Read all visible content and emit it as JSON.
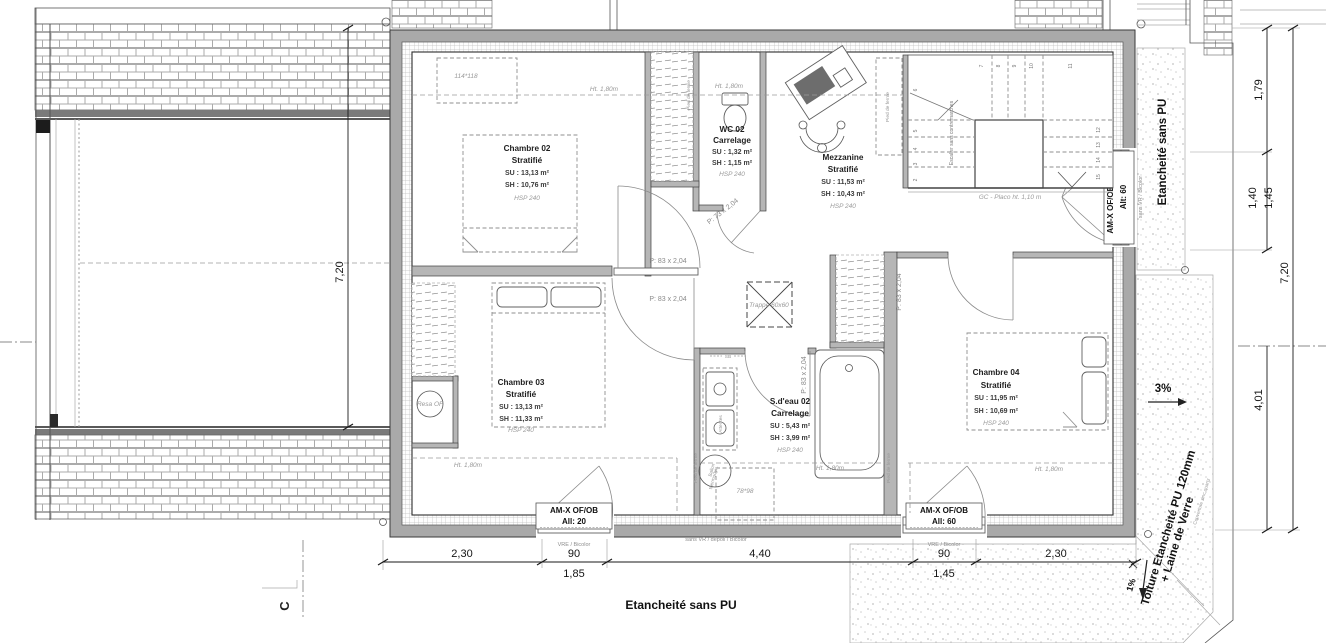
{
  "rooms": {
    "chambre02": {
      "name": "Chambre 02",
      "finish": "Stratifié",
      "su": "SU : 13,13 m²",
      "sh": "SH : 10,76 m²",
      "hsp": "HSP 240"
    },
    "wc02": {
      "name": "WC 02",
      "finish": "Carrelage",
      "su": "SU : 1,32 m²",
      "sh": "SH : 1,15 m²",
      "hsp": "HSP 240"
    },
    "mezzanine": {
      "name": "Mezzanine",
      "finish": "Stratifié",
      "su": "SU : 11,53 m²",
      "sh": "SH : 10,43 m²",
      "hsp": "HSP 240"
    },
    "chambre03": {
      "name": "Chambre 03",
      "finish": "Stratifié",
      "su": "SU : 13,13 m²",
      "sh": "SH : 11,33 m²",
      "hsp": "HSP 240"
    },
    "sdeau02": {
      "name": "S.d'eau 02",
      "finish": "Carrelage",
      "su": "SU : 5,43 m²",
      "sh": "SH : 3,99 m²",
      "hsp": "HSP 240"
    },
    "chambre04": {
      "name": "Chambre 04",
      "finish": "Stratifié",
      "su": "SU : 11,95 m²",
      "sh": "SH : 10,69 m²",
      "hsp": "HSP 240"
    }
  },
  "stairs": {
    "numbers": [
      "2",
      "3",
      "4",
      "5",
      "6",
      "7",
      "8",
      "9",
      "10",
      "11",
      "12",
      "13",
      "14",
      "15"
    ],
    "note": "Escalier sans contremarches",
    "gc": "GC - Placo ht. 1,10 m"
  },
  "doors": {
    "p83": "P: 83 x 2,04",
    "p73": "P: 73 x 2,04"
  },
  "windows": {
    "w20_1": "AM-X OF/OB",
    "w20_2": "All: 20",
    "w60_1": "AM-X OF/OB",
    "w60_2": "All: 60",
    "wfixe_1": "AM-X OF/OB + Fixe",
    "wfixe_2": "Alt: 60",
    "vre": "VRE / Bicolor",
    "sans_vr_bicolor": "sans VR / Bicolor",
    "sans_vr_depoli": "sans VR / dépoli / Bicolor"
  },
  "annotations": {
    "ht180": "Ht. 1,80m",
    "velux_top": "114*118",
    "velux_bottom": "78*98",
    "trappe": "Trappe 60x60",
    "resa": "Resa OF",
    "attentes": "Attentes",
    "sb": "SB",
    "ballon_1": "Ballon",
    "ballon_2": "thermodyn.",
    "pied_de_ferme": "Pied de ferme",
    "etancheite": "Etancheité sans PU",
    "toiture_1": "Toiture Etancheité PU 120mm",
    "toiture_2": "+ Laine de Verre",
    "couverture": "Couverture zinc quartz",
    "slope3": "3%",
    "slope1": "1%",
    "section": "C"
  },
  "dims": {
    "b1": "2,30",
    "b2": "90",
    "b2s": "1,85",
    "b3": "4,40",
    "b4": "90",
    "b4s": "1,45",
    "b5": "2,30",
    "left720": "7,20",
    "r179": "1,79",
    "r140": "1,40",
    "r145": "1,45",
    "r720": "7,20",
    "r401": "4,01"
  },
  "colors": {
    "wall": "#a9a9a9",
    "ink": "#3a3a3a",
    "hatch": "#ababab"
  }
}
